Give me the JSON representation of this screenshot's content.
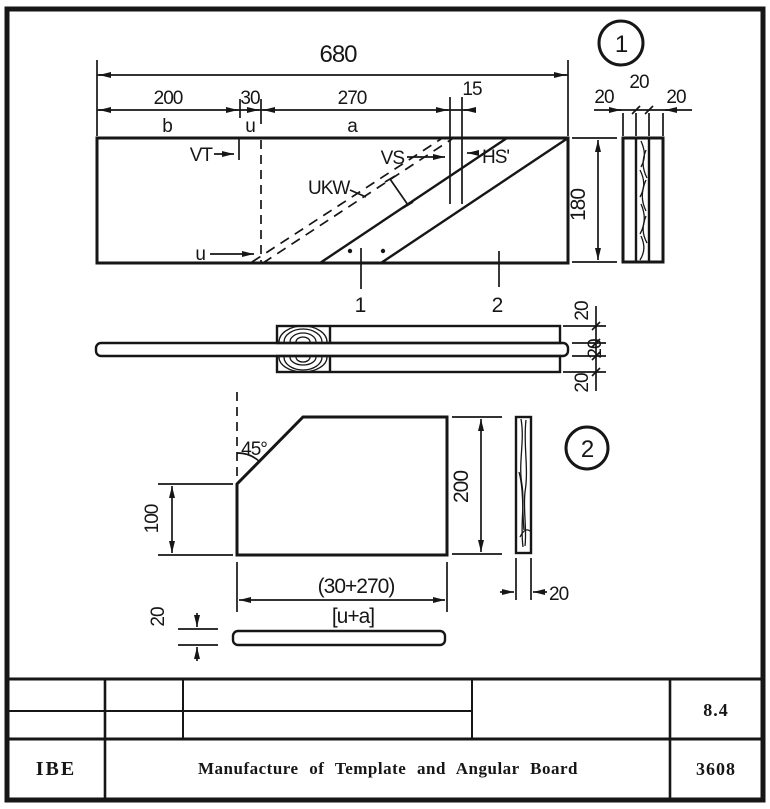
{
  "sheet": {
    "bg": "#ffffff",
    "ink": "#161616"
  },
  "view1": {
    "callout": "1",
    "dim_overall": "680",
    "dim_b": "200",
    "dim_u": "30",
    "dim_a": "270",
    "dim_kerf": "15",
    "label_b": "b",
    "label_u": "u",
    "label_a": "a",
    "dim_height": "180",
    "label_vt": "VT",
    "label_vs": "VS",
    "label_hs": "HS'",
    "label_ukw": "UKW",
    "label_u_edge": "u",
    "part1": "1",
    "part2": "2",
    "edge_dims": [
      "20",
      "20",
      "20"
    ]
  },
  "section": {
    "layer_dims": [
      "20",
      "20",
      "20"
    ]
  },
  "view2": {
    "callout": "2",
    "angle": "45°",
    "dim_left_height": "100",
    "dim_height": "200",
    "dim_width": "(30+270)",
    "dim_width_formula": "[u+a]",
    "dim_strip_thickness": "20",
    "dim_side_thickness": "20"
  },
  "title_block": {
    "org": "IBE",
    "title": "Manufacture of Template and Angular Board",
    "code": "8.4",
    "number": "3608"
  }
}
